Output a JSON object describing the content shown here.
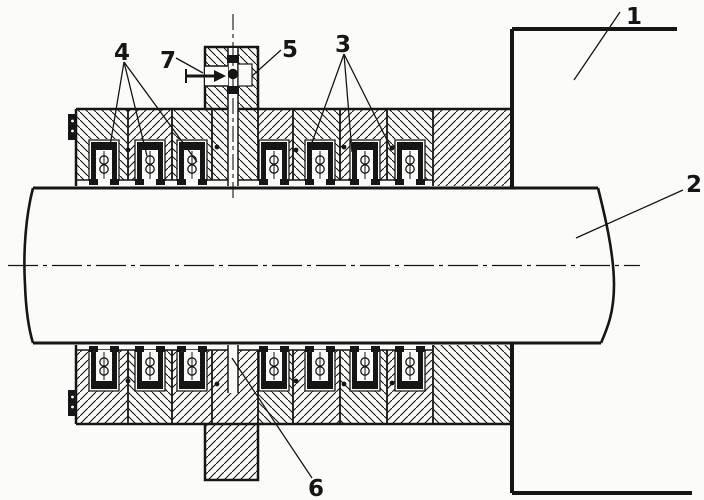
{
  "drawing": {
    "background": "#fbfbf9",
    "line_color": "#161616",
    "callouts": [
      {
        "number": "1"
      },
      {
        "number": "2"
      },
      {
        "number": "3"
      },
      {
        "number": "4"
      },
      {
        "number": "5"
      },
      {
        "number": "6"
      },
      {
        "number": "7"
      }
    ]
  }
}
